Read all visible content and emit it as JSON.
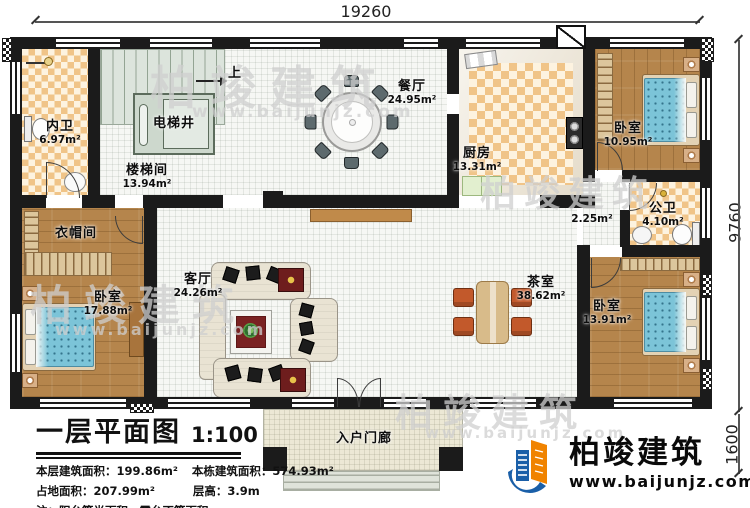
{
  "colors": {
    "wall": "#1b1b1b",
    "floor_white": "#f6f7f4",
    "tile_dark": "#f0c488",
    "tile_light": "#fdf3e0",
    "wood": "#b5854c",
    "stairs": "#dce4dc",
    "elevator": "#cdd8cd",
    "bed_blue": "#7cc4d8",
    "bed_frame": "#e3d2b4",
    "sofa": "#e9e3d3",
    "rug": "#7a2222",
    "side_table": "#6e1d1d",
    "chair_gray": "#5d6a6d",
    "chair_orange": "#c2592b",
    "table_tan": "#d8bb8a",
    "cabinet": "#c08a4a",
    "porch": "#ece8d5",
    "green_table": "#e2efcf",
    "logo_blue": "#1a5fa8",
    "logo_orange": "#f08300",
    "watermark": "#cfcfcf"
  },
  "dims": {
    "top": "19260",
    "right_main": "9760",
    "right_porch": "1600"
  },
  "rooms": {
    "inner_bath": {
      "name": "内卫",
      "area": "6.97m²"
    },
    "stair_hall": {
      "name": "楼梯间",
      "area": "13.94m²"
    },
    "elevator": {
      "name": "电梯井"
    },
    "stairs_up": {
      "label": "上"
    },
    "dining": {
      "name": "餐厅",
      "area": "24.95m²"
    },
    "kitchen": {
      "name": "厨房",
      "area": "13.31m²"
    },
    "bedroom_tr": {
      "name": "卧室",
      "area": "10.95m²"
    },
    "public_bath": {
      "name": "公卫",
      "area": "4.10m²"
    },
    "corridor": {
      "area": "2.25m²"
    },
    "bedroom_br": {
      "name": "卧室",
      "area": "13.91m²"
    },
    "tea_room": {
      "name": "茶室",
      "area": "38.62m²"
    },
    "living": {
      "name": "客厅",
      "area": "24.26m²"
    },
    "cloakroom": {
      "name": "衣帽间"
    },
    "bedroom_bl": {
      "name": "卧室",
      "area": "17.88m²"
    },
    "porch": {
      "name": "入户门廊"
    }
  },
  "titleblock": {
    "title": "一层平面图",
    "scale": "1:100",
    "stats": [
      {
        "label": "本层建筑面积：",
        "value": "199.86m²"
      },
      {
        "label": "本栋建筑面积：",
        "value": "574.93m²"
      },
      {
        "label": "占地面积：",
        "value": "207.99m²"
      },
      {
        "label": "层高：",
        "value": "3.9m"
      }
    ],
    "note": "注：阳台算半面积，露台不算面积"
  },
  "logo": {
    "name": "柏竣建筑",
    "url": "www.baijunjz.com"
  },
  "watermark": {
    "text": "柏竣建筑",
    "url": "www.baijunjz.com"
  }
}
